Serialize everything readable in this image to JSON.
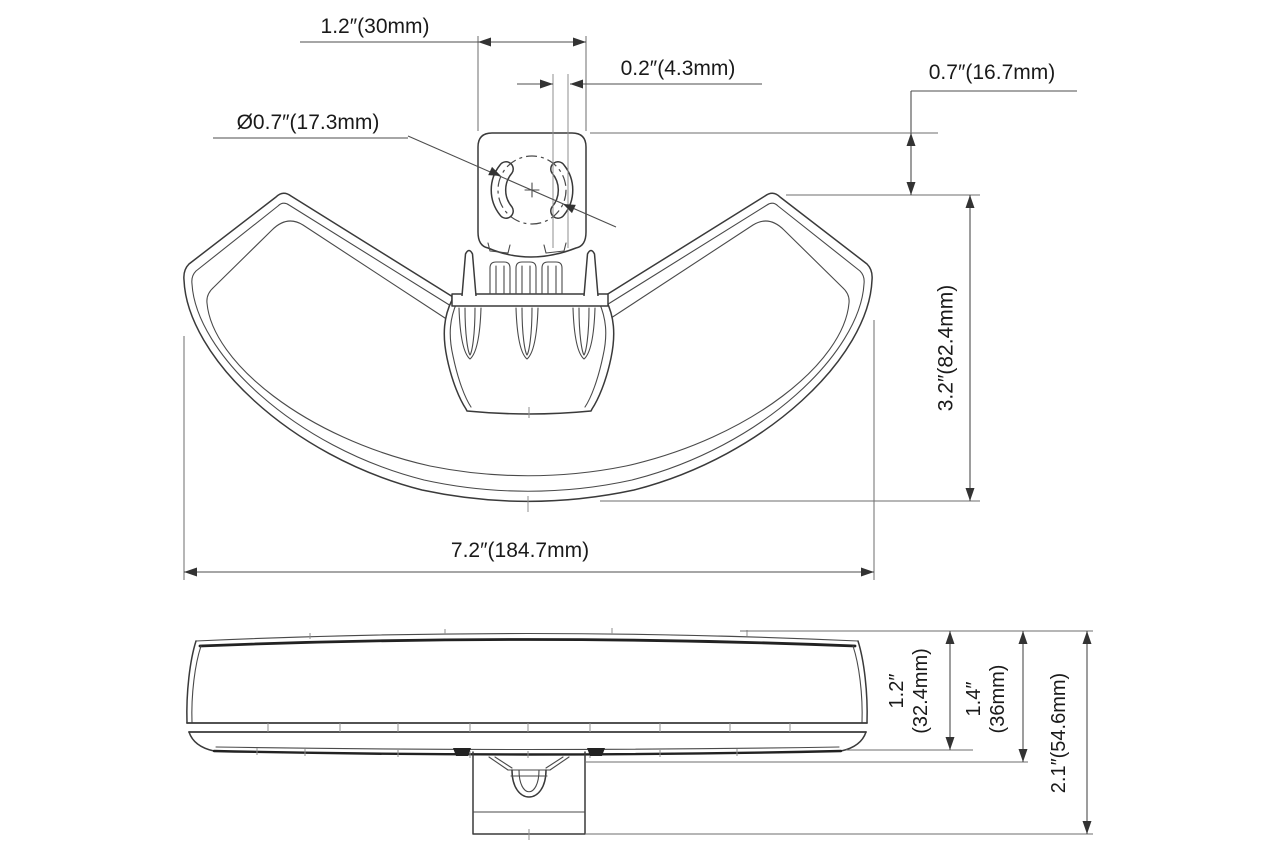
{
  "drawing": {
    "type": "product-dimension-drawing",
    "views": [
      "front",
      "side"
    ],
    "line_color": "#3a3a3a",
    "background": "#ffffff"
  },
  "dimensions": {
    "bracket_width": "1.2″(30mm)",
    "slot_width": "0.2″(4.3mm)",
    "hole_diameter": "Ø0.7″(17.3mm)",
    "bracket_offset": "0.7″(16.7mm)",
    "body_height": "3.2″(82.4mm)",
    "overall_width": "7.2″(184.7mm)",
    "lens_height_in": "1.2″",
    "lens_height_mm": "(32.4mm)",
    "base_height_in": "1.4″",
    "base_height_mm": "(36mm)",
    "total_height": "2.1″(54.6mm)"
  }
}
